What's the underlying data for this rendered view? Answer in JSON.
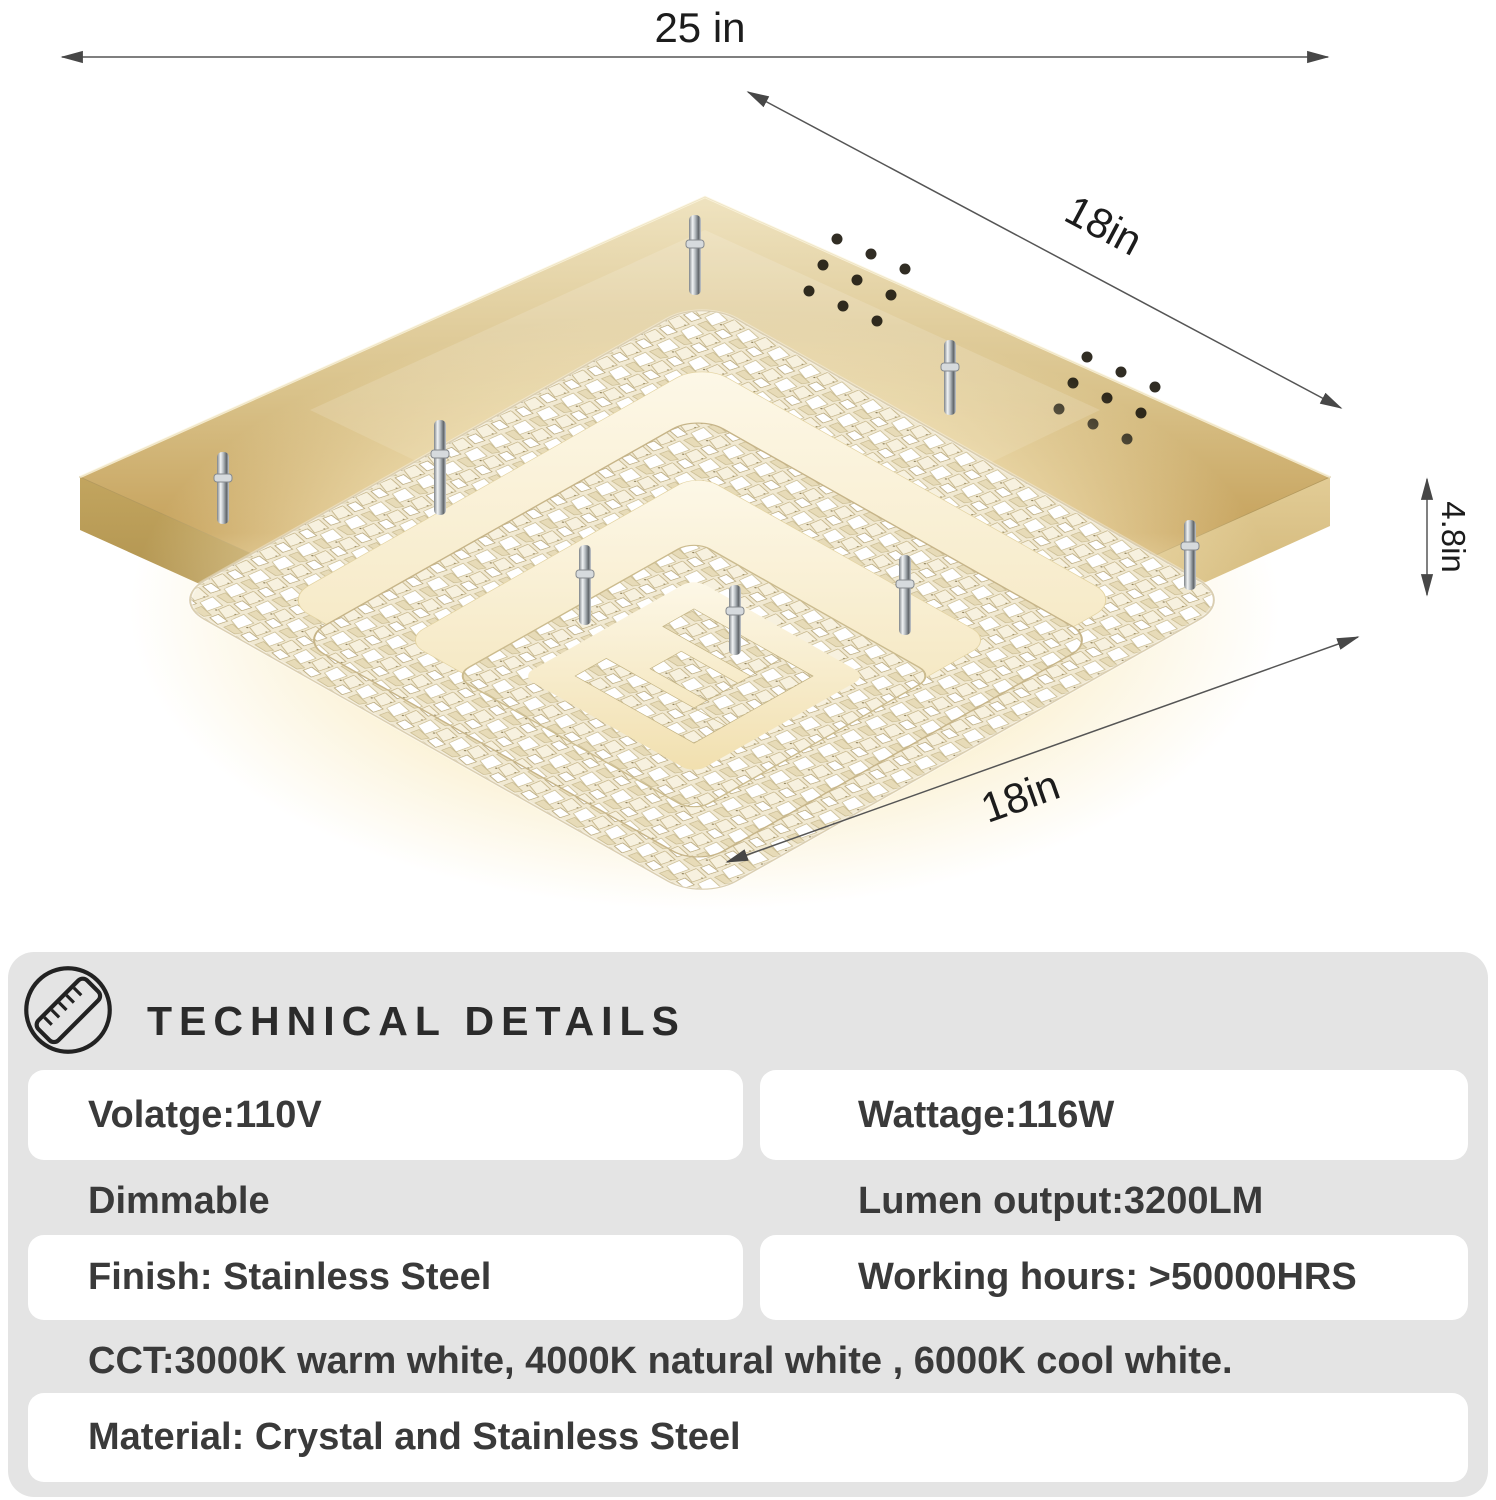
{
  "product_diagram": {
    "dim_width_top": "25 in",
    "dim_depth_right": "18in",
    "dim_height_right": "4.8in",
    "dim_width_bottom": "18in"
  },
  "technical_details": {
    "title": "TECHNICAL DETAILS",
    "icon": "ruler-icon",
    "specs": {
      "voltage": "Volatge:110V",
      "wattage": "Wattage:116W",
      "dimmable": "Dimmable",
      "lumen_output": "Lumen output:3200LM",
      "finish": "Finish: Stainless Steel",
      "working_hours": "Working hours: >50000HRS",
      "cct": "CCT:3000K warm white, 4000K natural white , 6000K cool white.",
      "material": "Material: Crystal and Stainless Steel"
    }
  },
  "colors": {
    "panel_background": "#e4e4e4",
    "card_background": "#ffffff",
    "text_primary": "#3a3a3a",
    "dimension_line": "#4a4a4a",
    "gold_plate": "#c9ab6a",
    "warm_glow": "#f5e7c0"
  }
}
